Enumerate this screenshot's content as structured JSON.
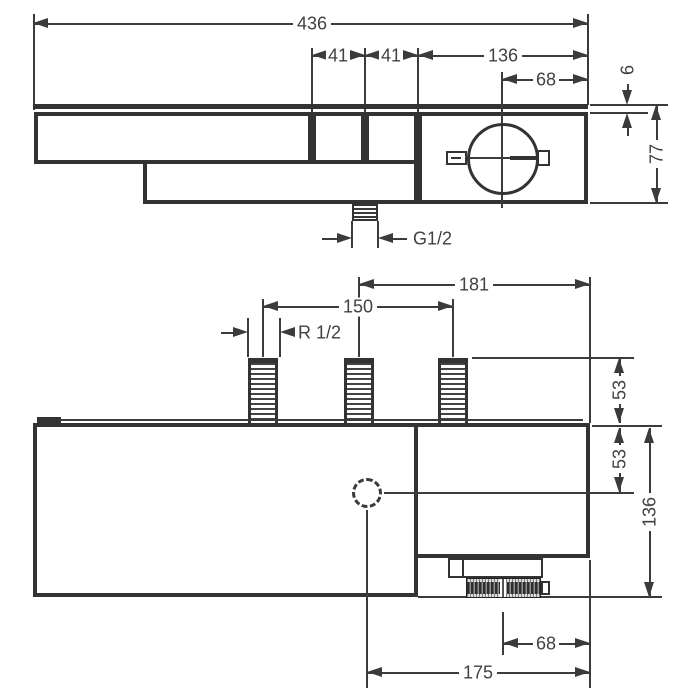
{
  "drawing": {
    "kind": "technical-dimension-drawing",
    "background": "#ffffff",
    "line_color": "#3a3a3a",
    "views": {
      "top_view": {
        "name": "top view",
        "dims": {
          "total_width": "436",
          "segment_1": "41",
          "segment_2": "41",
          "handle_section_width": "136",
          "handle_center_offset": "68",
          "plate_thickness": "6",
          "body_depth": "77",
          "bottom_outlet_thread": "G1/2"
        }
      },
      "front_view": {
        "name": "front view",
        "dims": {
          "inlet_to_right_edge": "181",
          "inlet_spacing": "150",
          "inlet_thread": "R 1/2",
          "inlet_height": "53",
          "outlet_center_offset": "53",
          "total_height": "136",
          "knob_center_offset": "68",
          "outlet_to_right_edge": "175"
        }
      }
    }
  }
}
